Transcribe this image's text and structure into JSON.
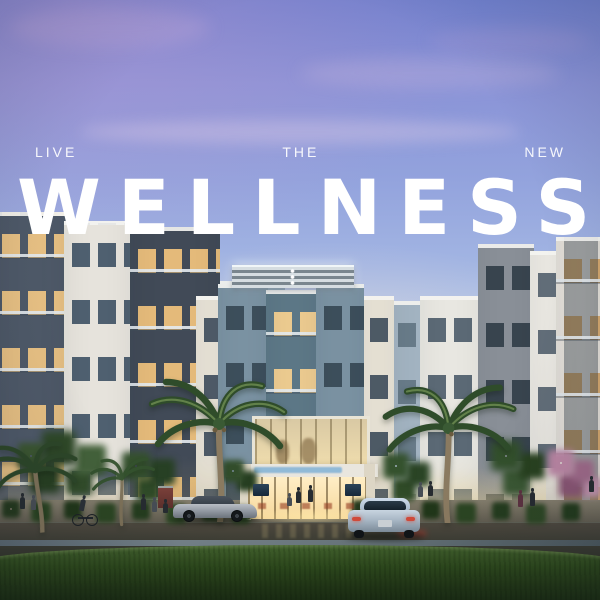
{
  "overlay": {
    "kicker_left": "LIVE",
    "kicker_center": "THE",
    "kicker_right": "NEW",
    "headline": "WELLNESS"
  },
  "colors": {
    "overlay_text": "#ffffff",
    "sky_top_left_purple": "#8a8ad4",
    "sky_top_right_blue": "#6080d0",
    "sky_horizon": "#d8e5f3",
    "dusk_haze_pink": "#f3e0d8",
    "building_slate_blue": "#7b93a3",
    "building_charcoal": "#414a57",
    "building_cream": "#e9e4d7",
    "window_glow_warm": "#eccb90",
    "entrance_lobby_glow": "#ffeec4",
    "entrance_sign_blue": "#80b2d6",
    "lawn_green": "#2f4722",
    "road_asphalt": "#33362e",
    "flowering_tree_pink": "#bb86a4"
  }
}
